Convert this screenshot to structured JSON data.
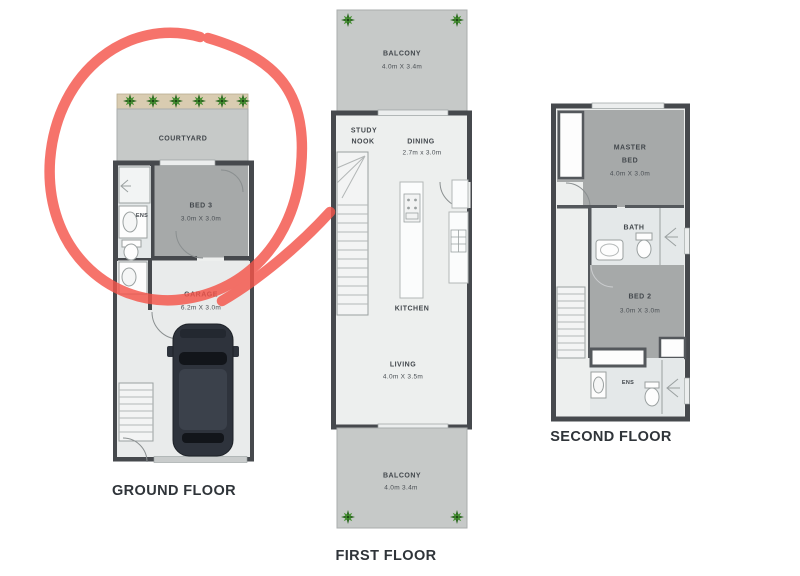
{
  "page": {
    "background": "#ffffff"
  },
  "colors": {
    "wall": "#46494d",
    "room_gray": "#a6a9a9",
    "outdoor_gray": "#c6c9c8",
    "floor_light": "#edefee",
    "bath_floor": "#e4e8e9",
    "garden_strip": "#d9ccb1",
    "plant_green": "#2f6b24",
    "marker_red": "#f4544a",
    "label_text": "#42474c",
    "title_text": "#2f3439"
  },
  "annotation": {
    "kind": "hand-drawn marker circle with tail",
    "color": "#f4544a",
    "circled_area": "COURTYARD and BED 3 on ground floor"
  },
  "icon_names": [
    "plant-icon",
    "car-icon",
    "toilet-icon",
    "sink-icon",
    "shower-icon",
    "bathtub-icon",
    "stove-icon",
    "staircase",
    "wardrobe",
    "door-arc",
    "garage-door",
    "kitchen-island"
  ],
  "floors": {
    "ground": {
      "title": "GROUND FLOOR",
      "courtyard": {
        "name": "COURTYARD"
      },
      "ens": {
        "name": "ENS"
      },
      "bed3": {
        "name": "BED 3",
        "dims": "3.0m X 3.0m"
      },
      "garage": {
        "name": "GARAGE",
        "dims": "6.2m X 3.0m"
      }
    },
    "first": {
      "title": "FIRST FLOOR",
      "balcony_top": {
        "name": "BALCONY",
        "dims": "4.0m X 3.4m"
      },
      "study_nook": {
        "line1": "STUDY",
        "line2": "NOOK"
      },
      "dining": {
        "name": "DINING",
        "dims": "2.7m x 3.0m"
      },
      "kitchen": {
        "name": "KITCHEN"
      },
      "living": {
        "name": "LIVING",
        "dims": "4.0m X 3.5m"
      },
      "balcony_bottom": {
        "name": "BALCONY",
        "dims": "4.0m 3.4m"
      }
    },
    "second": {
      "title": "SECOND FLOOR",
      "master_bed": {
        "line1": "MASTER",
        "line2": "BED",
        "dims": "4.0m X 3.0m"
      },
      "bath": {
        "name": "BATH"
      },
      "bed2": {
        "name": "BED 2",
        "dims": "3.0m X 3.0m"
      },
      "ens": {
        "name": "ENS"
      }
    }
  }
}
